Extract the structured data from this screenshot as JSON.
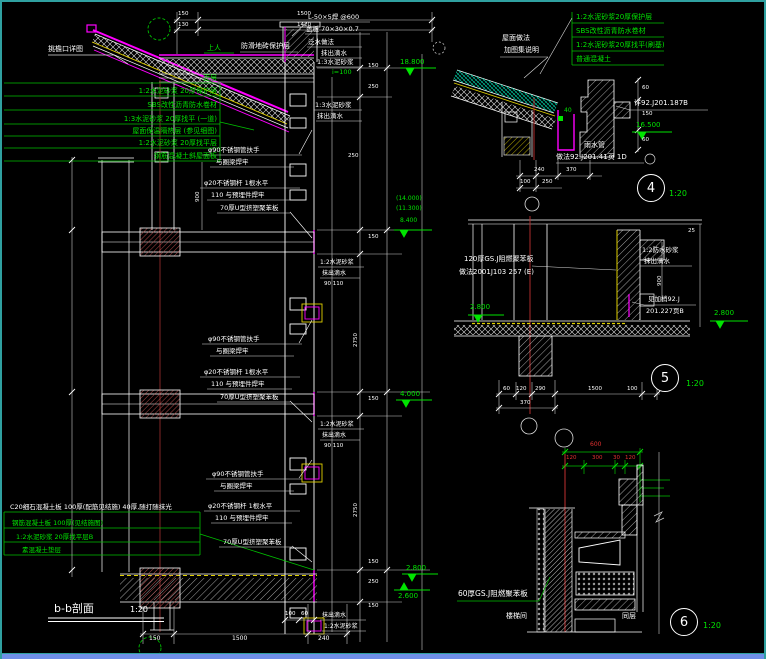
{
  "palette": {
    "background": "#000000",
    "frame_teal": "#2fa0a0",
    "bottom_blue": "#6f8fe8",
    "line_white": "#ffffff",
    "note_green": "#00e400",
    "magenta": "#ff00ff",
    "yellow": "#ffff00",
    "dim_red": "#e03030"
  },
  "main_section": {
    "title": "b-b剖面",
    "scale": "1:20",
    "eave_note": "挑檐口详图",
    "walkable_note": "上人",
    "tile_note": "防滑地砖保护层",
    "roof_layers": [
      "面层",
      "1:2水泥砂浆 20厚保护层",
      "SBS改性沥青防水卷材",
      "1:3水泥砂浆 20厚找平 (一道)",
      "屋面保温隔热层 (参见细图)",
      "1:2水泥砂浆 20厚找平层",
      "钢筋混凝土斜屋面板"
    ],
    "parapet_notes": [
      "L-50×5焊 @600",
      "盖板 70×30×0.7",
      "泛水做法",
      "抹出滴水",
      "1:3水泥砂浆",
      "1:3水泥砂浆",
      "抹出滴水"
    ],
    "slope_note": "i=100",
    "railing_notes": [
      "φ90不锈钢管扶手",
      "与圈梁焊牢",
      "φ20不锈钢杆 1根水平",
      "110 与预埋件焊牢",
      "70厚U型挤塑聚苯板"
    ],
    "band_notes": [
      "1:2水泥砂浆",
      "抹出滴水"
    ],
    "band_dims": "90 110",
    "floor_layers": [
      "C20细石混凝土板  100厚(配筋见结施)  40厚,随打随抹光",
      "钢筋混凝土板 100厚(见结施图)",
      "1:2水泥砂浆 20厚找平层B",
      "素混凝土垫层"
    ],
    "bottom_notes": [
      "抹出滴水",
      "1:2水泥砂浆"
    ],
    "elevations": {
      "top": "18.800",
      "group": [
        "(14.000)",
        "(11.300)",
        "8.400"
      ],
      "mid": "4.000",
      "low1": "2.800",
      "low2": "2.600"
    },
    "dims": {
      "top_row1": [
        "150",
        "1500"
      ],
      "top_row2": [
        "130",
        "1420"
      ],
      "right": [
        "150",
        "250",
        "250",
        "150",
        "2750",
        "150",
        "2750",
        "150",
        "250",
        "150"
      ],
      "rail_height": "900",
      "bottom": [
        "150",
        "1500",
        "240"
      ],
      "bottom_small": [
        "100",
        "60"
      ]
    }
  },
  "detail4": {
    "number": "4",
    "scale": "1:20",
    "layer_notes": [
      "1:2水泥砂浆20厚保护层",
      "SBS改性沥青防水卷材",
      "1:2水泥砂浆20厚找平(刷基)",
      "普通混凝土"
    ],
    "side_note1": "屋面做法",
    "side_note2": "加图集说明",
    "ref_note": "详92.J201.187B",
    "elevation": "16.500",
    "pipe_note1": "雨水管",
    "pipe_note2": "做法92.J201.41页 1D",
    "green_mark": "40",
    "dims": {
      "row1": [
        "240",
        "370"
      ],
      "row2": [
        "100",
        "250"
      ],
      "right": [
        "60",
        "150",
        "60"
      ]
    }
  },
  "detail5": {
    "number": "5",
    "scale": "1:20",
    "board_note1": "120厚GS.J阻燃聚苯板",
    "board_note2": "做法2001J103 257 (E)",
    "right_note1": "1:2防水砂浆",
    "right_note2": "抹出滴水",
    "ref_note1": "见加梢92.J",
    "ref_note2": "201.227页B",
    "elev_left": "2.800",
    "elev_right": "2.800",
    "dims": {
      "bottom": [
        "60",
        "120",
        "290",
        "1500",
        "100"
      ],
      "bottom2": "370",
      "vertical": "900",
      "top_right": "25"
    }
  },
  "detail6": {
    "number": "6",
    "scale": "1:20",
    "board_note": "60厚GS.J阻燃聚苯板",
    "label_left": "楼梯间",
    "label_right": "同层",
    "dims": {
      "total": "600",
      "sub": [
        "120",
        "300",
        "30",
        "120"
      ]
    }
  }
}
